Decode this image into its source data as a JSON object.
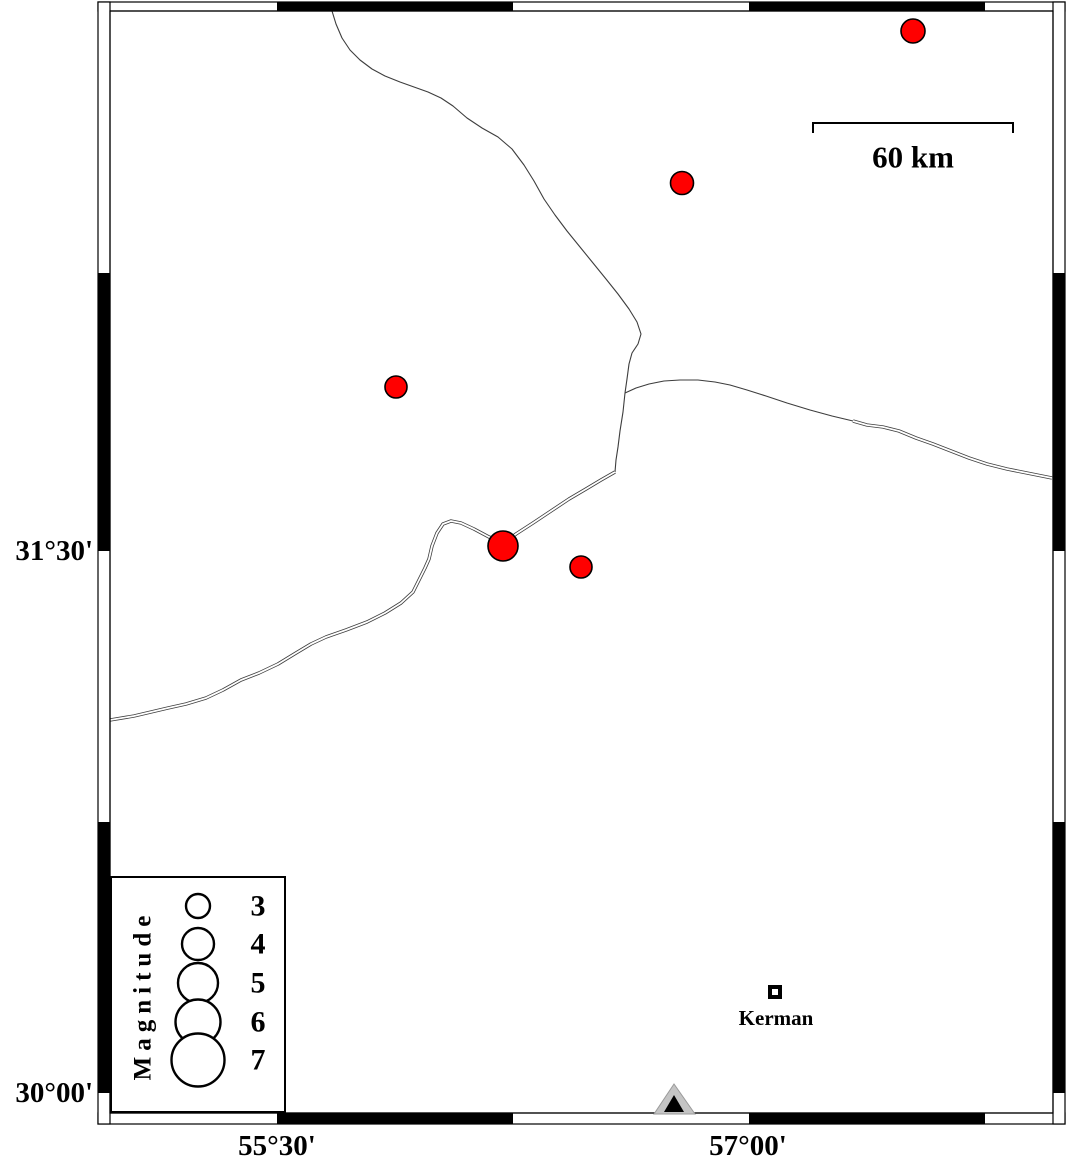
{
  "map": {
    "colors": {
      "background": "#ffffff",
      "quake_fill": "#ff0000",
      "quake_stroke": "#000000",
      "line": "#3d3d3d",
      "frame": "#000000",
      "station_gray": "#c4c4c4",
      "station_black": "#000000"
    },
    "frame": {
      "outer": [
        98,
        2,
        1065,
        1124
      ],
      "inner": [
        110,
        11,
        1053,
        1113
      ],
      "h_black_segments": [
        [
          277,
          513
        ],
        [
          749,
          985
        ]
      ],
      "v_black_segments": [
        [
          273,
          551
        ],
        [
          822,
          1093
        ]
      ]
    },
    "axis": {
      "left_labels": [
        {
          "label": "31°30'",
          "y": 551
        },
        {
          "label": "30°00'",
          "y": 1093
        }
      ],
      "bottom_labels": [
        {
          "label": "55°30'",
          "x": 277
        },
        {
          "label": "57°00'",
          "x": 748
        }
      ]
    },
    "scalebar": {
      "label": "60 km",
      "x1": 813,
      "x2": 1013,
      "y": 123,
      "drop": 10,
      "label_x": 913,
      "label_y": 157
    },
    "earthquakes": [
      {
        "x": 913,
        "y": 31,
        "r": 12
      },
      {
        "x": 682,
        "y": 183,
        "r": 11.5
      },
      {
        "x": 396,
        "y": 387,
        "r": 11
      },
      {
        "x": 503,
        "y": 546,
        "r": 15
      },
      {
        "x": 581,
        "y": 567,
        "r": 11
      }
    ],
    "lines": [
      {
        "name": "fault-line-north",
        "double": false,
        "points": [
          [
            332,
            11
          ],
          [
            336,
            24
          ],
          [
            342,
            38
          ],
          [
            350,
            50
          ],
          [
            360,
            60
          ],
          [
            372,
            69
          ],
          [
            385,
            76
          ],
          [
            400,
            82
          ],
          [
            414,
            87
          ],
          [
            428,
            92
          ],
          [
            441,
            98
          ],
          [
            453,
            106
          ],
          [
            467,
            118
          ],
          [
            482,
            128
          ],
          [
            498,
            137
          ],
          [
            512,
            149
          ],
          [
            524,
            165
          ],
          [
            534,
            181
          ],
          [
            544,
            199
          ],
          [
            555,
            215
          ],
          [
            567,
            231
          ],
          [
            580,
            247
          ],
          [
            593,
            263
          ],
          [
            606,
            279
          ],
          [
            618,
            294
          ],
          [
            629,
            309
          ],
          [
            637,
            322
          ],
          [
            641,
            334
          ],
          [
            638,
            344
          ],
          [
            632,
            353
          ],
          [
            629,
            364
          ],
          [
            627,
            379
          ],
          [
            625,
            393
          ]
        ]
      },
      {
        "name": "fault-line-connector",
        "double": false,
        "points": [
          [
            625,
            393
          ],
          [
            623,
            412
          ],
          [
            620,
            431
          ],
          [
            618,
            447
          ],
          [
            616,
            460
          ],
          [
            615,
            472
          ]
        ]
      },
      {
        "name": "road-east-single",
        "double": false,
        "points": [
          [
            625,
            393
          ],
          [
            636,
            388
          ],
          [
            649,
            384
          ],
          [
            664,
            381
          ],
          [
            680,
            380
          ],
          [
            698,
            380
          ],
          [
            715,
            382
          ],
          [
            730,
            385
          ],
          [
            747,
            390
          ],
          [
            766,
            396
          ],
          [
            787,
            403
          ],
          [
            810,
            410
          ],
          [
            832,
            416
          ],
          [
            853,
            421
          ]
        ]
      },
      {
        "name": "road-east-double",
        "double": true,
        "points": [
          [
            853,
            421
          ],
          [
            867,
            425
          ],
          [
            883,
            427
          ],
          [
            899,
            431
          ],
          [
            916,
            438
          ],
          [
            933,
            444
          ],
          [
            951,
            451
          ],
          [
            969,
            458
          ],
          [
            987,
            464
          ],
          [
            1007,
            469
          ],
          [
            1027,
            473
          ],
          [
            1052,
            478
          ]
        ]
      },
      {
        "name": "road-southwest-double",
        "double": true,
        "points": [
          [
            615,
            472
          ],
          [
            601,
            480
          ],
          [
            586,
            489
          ],
          [
            569,
            499
          ],
          [
            551,
            511
          ],
          [
            533,
            523
          ],
          [
            516,
            534
          ],
          [
            504,
            543
          ],
          [
            489,
            537
          ],
          [
            474,
            529
          ],
          [
            461,
            523
          ],
          [
            451,
            521
          ],
          [
            443,
            524
          ],
          [
            437,
            533
          ],
          [
            432,
            546
          ],
          [
            429,
            559
          ],
          [
            425,
            568
          ],
          [
            420,
            578
          ],
          [
            413,
            592
          ],
          [
            401,
            603
          ],
          [
            385,
            613
          ],
          [
            367,
            622
          ],
          [
            346,
            630
          ],
          [
            326,
            637
          ],
          [
            311,
            644
          ],
          [
            296,
            653
          ],
          [
            278,
            664
          ],
          [
            259,
            673
          ],
          [
            241,
            680
          ],
          [
            223,
            690
          ],
          [
            206,
            698
          ],
          [
            186,
            704
          ],
          [
            168,
            708
          ],
          [
            151,
            712
          ],
          [
            134,
            716
          ],
          [
            110,
            720
          ]
        ]
      }
    ],
    "legend": {
      "title": "Magnitude",
      "box": [
        111,
        877,
        285,
        1112
      ],
      "title_x": 143,
      "title_y": 995,
      "circle_x": 198,
      "label_x": 258,
      "entries": [
        {
          "label": "3",
          "y": 906,
          "r": 12
        },
        {
          "label": "4",
          "y": 944,
          "r": 16
        },
        {
          "label": "5",
          "y": 983,
          "r": 20
        },
        {
          "label": "6",
          "y": 1022,
          "r": 22.5
        },
        {
          "label": "7",
          "y": 1060,
          "r": 26.5
        }
      ]
    },
    "city": {
      "name": "Kerman",
      "sq_x": 768,
      "sq_y": 985,
      "sq_size": 14,
      "sq_border": 4,
      "label_x": 776,
      "label_y": 1018
    },
    "station": {
      "outer_triangle": [
        [
          674,
          1084
        ],
        [
          654,
          1114
        ],
        [
          695,
          1114
        ]
      ],
      "inner_triangle": [
        [
          674,
          1095
        ],
        [
          664,
          1112
        ],
        [
          684,
          1112
        ]
      ]
    }
  }
}
